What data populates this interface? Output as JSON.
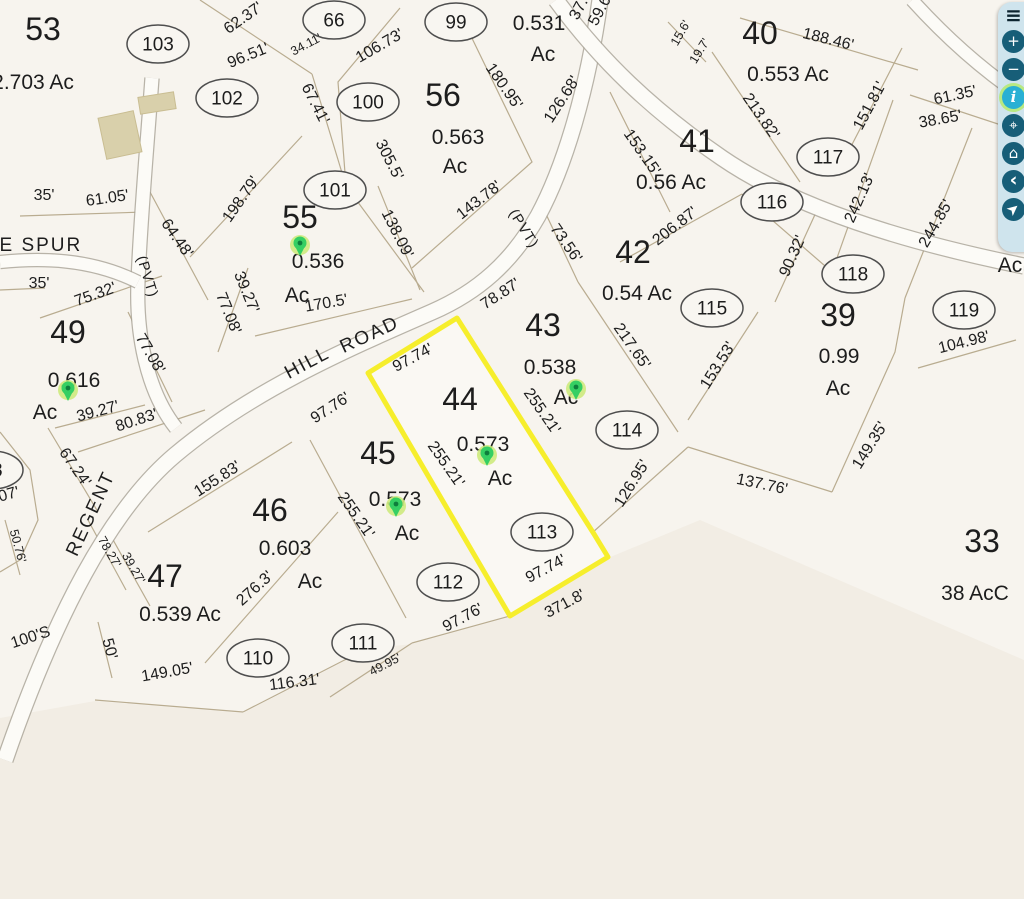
{
  "map": {
    "background": "#f7f4ee",
    "shade_color": "#efe8dc",
    "line_color": "#b9ac90",
    "road_fill": "#fcfbf7",
    "road_casing": "#a8a296",
    "highlight_color": "#f6ee2c",
    "pin_color": "#35cf63",
    "pin_dot_color": "#0e7e3c",
    "pin_glow_color": "#cdea7d",
    "building_color": "#d9d0ab",
    "labels": [
      {
        "t": "53",
        "x": 43,
        "y": 40,
        "r": 0,
        "c": "lot"
      },
      {
        "t": "55",
        "x": 300,
        "y": 228,
        "r": 0,
        "c": "lot"
      },
      {
        "t": "56",
        "x": 443,
        "y": 106,
        "r": 0,
        "c": "lot"
      },
      {
        "t": "40",
        "x": 760,
        "y": 44,
        "r": 0,
        "c": "lot"
      },
      {
        "t": "41",
        "x": 697,
        "y": 152,
        "r": 0,
        "c": "lot"
      },
      {
        "t": "42",
        "x": 633,
        "y": 263,
        "r": 0,
        "c": "lot"
      },
      {
        "t": "43",
        "x": 543,
        "y": 336,
        "r": 0,
        "c": "lot"
      },
      {
        "t": "39",
        "x": 838,
        "y": 326,
        "r": 0,
        "c": "lot"
      },
      {
        "t": "44",
        "x": 460,
        "y": 410,
        "r": 0,
        "c": "lot"
      },
      {
        "t": "45",
        "x": 378,
        "y": 464,
        "r": 0,
        "c": "lot"
      },
      {
        "t": "46",
        "x": 270,
        "y": 521,
        "r": 0,
        "c": "lot"
      },
      {
        "t": "47",
        "x": 165,
        "y": 587,
        "r": 0,
        "c": "lot"
      },
      {
        "t": "49",
        "x": 68,
        "y": 343,
        "r": 0,
        "c": "lot"
      },
      {
        "t": "33",
        "x": 982,
        "y": 552,
        "r": 0,
        "c": "lot"
      },
      {
        "t": "2.703 Ac",
        "x": 33,
        "y": 89,
        "r": 0,
        "c": "ac"
      },
      {
        "t": "0.536",
        "x": 318,
        "y": 268,
        "r": 0,
        "c": "ac"
      },
      {
        "t": "Ac",
        "x": 297,
        "y": 302,
        "r": 0,
        "c": "ac"
      },
      {
        "t": "0.563",
        "x": 458,
        "y": 144,
        "r": 0,
        "c": "ac"
      },
      {
        "t": "Ac",
        "x": 455,
        "y": 173,
        "r": 0,
        "c": "ac"
      },
      {
        "t": "0.531",
        "x": 539,
        "y": 30,
        "r": 0,
        "c": "ac"
      },
      {
        "t": "Ac",
        "x": 543,
        "y": 61,
        "r": 0,
        "c": "ac"
      },
      {
        "t": "0.553 Ac",
        "x": 788,
        "y": 81,
        "r": 0,
        "c": "ac"
      },
      {
        "t": "0.56 Ac",
        "x": 671,
        "y": 189,
        "r": 0,
        "c": "ac"
      },
      {
        "t": "0.54 Ac",
        "x": 637,
        "y": 300,
        "r": 0,
        "c": "ac"
      },
      {
        "t": "0.538",
        "x": 550,
        "y": 374,
        "r": 0,
        "c": "ac"
      },
      {
        "t": "Ac",
        "x": 566,
        "y": 404,
        "r": 0,
        "c": "ac"
      },
      {
        "t": "0.99",
        "x": 839,
        "y": 363,
        "r": 0,
        "c": "ac"
      },
      {
        "t": "Ac",
        "x": 838,
        "y": 395,
        "r": 0,
        "c": "ac"
      },
      {
        "t": "0.573",
        "x": 483,
        "y": 451,
        "r": 0,
        "c": "ac"
      },
      {
        "t": "Ac",
        "x": 500,
        "y": 485,
        "r": 0,
        "c": "ac"
      },
      {
        "t": "0.573",
        "x": 395,
        "y": 506,
        "r": 0,
        "c": "ac"
      },
      {
        "t": "Ac",
        "x": 407,
        "y": 540,
        "r": 0,
        "c": "ac"
      },
      {
        "t": "0.603",
        "x": 285,
        "y": 555,
        "r": 0,
        "c": "ac"
      },
      {
        "t": "Ac",
        "x": 310,
        "y": 588,
        "r": 0,
        "c": "ac"
      },
      {
        "t": "0.539 Ac",
        "x": 180,
        "y": 621,
        "r": 0,
        "c": "ac"
      },
      {
        "t": "0.616",
        "x": 74,
        "y": 387,
        "r": 0,
        "c": "ac"
      },
      {
        "t": "Ac",
        "x": 45,
        "y": 419,
        "r": 0,
        "c": "ac"
      },
      {
        "t": "38 AcC",
        "x": 975,
        "y": 600,
        "r": 0,
        "c": "ac"
      },
      {
        "t": "Ac",
        "x": 1010,
        "y": 272,
        "r": 0,
        "c": "ac"
      },
      {
        "t": "62.37'",
        "x": 246,
        "y": 22,
        "r": -35,
        "c": "dim"
      },
      {
        "t": "96.51'",
        "x": 250,
        "y": 60,
        "r": -22,
        "c": "dim"
      },
      {
        "t": "34.11'",
        "x": 308,
        "y": 48,
        "r": -28,
        "c": "dims"
      },
      {
        "t": "106.73'",
        "x": 382,
        "y": 50,
        "r": -30,
        "c": "dim"
      },
      {
        "t": "67.41'",
        "x": 311,
        "y": 106,
        "r": 63,
        "c": "dim"
      },
      {
        "t": "305.5'",
        "x": 385,
        "y": 162,
        "r": 63,
        "c": "dim"
      },
      {
        "t": "180.95'",
        "x": 500,
        "y": 89,
        "r": 55,
        "c": "dim"
      },
      {
        "t": "126.68'",
        "x": 566,
        "y": 102,
        "r": -57,
        "c": "dim"
      },
      {
        "t": "37.",
        "x": 583,
        "y": 11,
        "r": -62,
        "c": "dim"
      },
      {
        "t": "59.6",
        "x": 604,
        "y": 13,
        "r": -62,
        "c": "dim"
      },
      {
        "t": "15.6'",
        "x": 684,
        "y": 35,
        "r": -60,
        "c": "dims"
      },
      {
        "t": "19.7'",
        "x": 703,
        "y": 53,
        "r": -58,
        "c": "dims"
      },
      {
        "t": "188.46'",
        "x": 827,
        "y": 44,
        "r": 14,
        "c": "dim"
      },
      {
        "t": "151.81'",
        "x": 874,
        "y": 108,
        "r": -62,
        "c": "dim"
      },
      {
        "t": "61.35'",
        "x": 956,
        "y": 100,
        "r": -12,
        "c": "dim"
      },
      {
        "t": "38.65'",
        "x": 941,
        "y": 124,
        "r": -10,
        "c": "dim"
      },
      {
        "t": "213.82'",
        "x": 757,
        "y": 119,
        "r": 55,
        "c": "dim"
      },
      {
        "t": "153.15'",
        "x": 638,
        "y": 155,
        "r": 55,
        "c": "dim"
      },
      {
        "t": "242.13'",
        "x": 864,
        "y": 200,
        "r": -66,
        "c": "dim"
      },
      {
        "t": "244.85'",
        "x": 940,
        "y": 226,
        "r": -60,
        "c": "dim"
      },
      {
        "t": "206.87'",
        "x": 678,
        "y": 230,
        "r": -38,
        "c": "dim"
      },
      {
        "t": "90.32'",
        "x": 797,
        "y": 258,
        "r": -66,
        "c": "dim"
      },
      {
        "t": "153.53'",
        "x": 722,
        "y": 368,
        "r": -58,
        "c": "dim"
      },
      {
        "t": "104.98'",
        "x": 965,
        "y": 347,
        "r": -14,
        "c": "dim"
      },
      {
        "t": "149.35'",
        "x": 874,
        "y": 448,
        "r": -58,
        "c": "dim"
      },
      {
        "t": "137.76'",
        "x": 761,
        "y": 489,
        "r": 12,
        "c": "dim"
      },
      {
        "t": "126.95'",
        "x": 636,
        "y": 486,
        "r": -58,
        "c": "dim"
      },
      {
        "t": "217.65'",
        "x": 628,
        "y": 349,
        "r": 55,
        "c": "dim"
      },
      {
        "t": "73.56'",
        "x": 562,
        "y": 246,
        "r": 55,
        "c": "dim"
      },
      {
        "t": "78.87'",
        "x": 503,
        "y": 298,
        "r": -33,
        "c": "dim"
      },
      {
        "t": "198.79'",
        "x": 245,
        "y": 202,
        "r": -55,
        "c": "dim"
      },
      {
        "t": "138.09'",
        "x": 393,
        "y": 236,
        "r": 63,
        "c": "dim"
      },
      {
        "t": "143.78'",
        "x": 482,
        "y": 204,
        "r": -38,
        "c": "dim"
      },
      {
        "t": "170.5'",
        "x": 327,
        "y": 308,
        "r": -10,
        "c": "dim"
      },
      {
        "t": "39.27'",
        "x": 242,
        "y": 294,
        "r": 68,
        "c": "dim"
      },
      {
        "t": "77.08'",
        "x": 224,
        "y": 315,
        "r": 68,
        "c": "dim"
      },
      {
        "t": "35'",
        "x": 44,
        "y": 200,
        "r": 0,
        "c": "dim"
      },
      {
        "t": "61.05'",
        "x": 108,
        "y": 203,
        "r": -8,
        "c": "dim"
      },
      {
        "t": "64.48'",
        "x": 173,
        "y": 241,
        "r": 55,
        "c": "dim"
      },
      {
        "t": "35'",
        "x": 39,
        "y": 288,
        "r": 0,
        "c": "dim"
      },
      {
        "t": "75.32'",
        "x": 97,
        "y": 299,
        "r": -20,
        "c": "dim"
      },
      {
        "t": "77.08'",
        "x": 146,
        "y": 356,
        "r": 60,
        "c": "dim"
      },
      {
        "t": "39.27'",
        "x": 99,
        "y": 416,
        "r": -15,
        "c": "dim"
      },
      {
        "t": "80.83'",
        "x": 138,
        "y": 425,
        "r": -18,
        "c": "dim"
      },
      {
        "t": "67.24'",
        "x": 71,
        "y": 470,
        "r": 55,
        "c": "dim"
      },
      {
        "t": "50.76'",
        "x": 14,
        "y": 547,
        "r": 75,
        "c": "dims"
      },
      {
        "t": "07'",
        "x": 10,
        "y": 499,
        "r": -15,
        "c": "dim"
      },
      {
        "t": "155.83'",
        "x": 220,
        "y": 483,
        "r": -33,
        "c": "dim"
      },
      {
        "t": "78.27'",
        "x": 106,
        "y": 554,
        "r": 60,
        "c": "dims"
      },
      {
        "t": "39.27'",
        "x": 130,
        "y": 570,
        "r": 60,
        "c": "dims"
      },
      {
        "t": "100'S",
        "x": 32,
        "y": 642,
        "r": -18,
        "c": "dim"
      },
      {
        "t": "50'",
        "x": 105,
        "y": 650,
        "r": 75,
        "c": "dim"
      },
      {
        "t": "149.05'",
        "x": 168,
        "y": 677,
        "r": -10,
        "c": "dim"
      },
      {
        "t": "116.31'",
        "x": 295,
        "y": 687,
        "r": -7,
        "c": "dim"
      },
      {
        "t": "276.3'",
        "x": 258,
        "y": 592,
        "r": -42,
        "c": "dim"
      },
      {
        "t": "255.21'",
        "x": 352,
        "y": 518,
        "r": 55,
        "c": "dim"
      },
      {
        "t": "255.21'",
        "x": 442,
        "y": 467,
        "r": 55,
        "c": "dim"
      },
      {
        "t": "255.21'",
        "x": 538,
        "y": 414,
        "r": 55,
        "c": "dim"
      },
      {
        "t": "97.76'",
        "x": 333,
        "y": 412,
        "r": -33,
        "c": "dim"
      },
      {
        "t": "97.74'",
        "x": 415,
        "y": 362,
        "r": -28,
        "c": "dim"
      },
      {
        "t": "97.74'",
        "x": 548,
        "y": 573,
        "r": -28,
        "c": "dim"
      },
      {
        "t": "371.8'",
        "x": 567,
        "y": 608,
        "r": -28,
        "c": "dim"
      },
      {
        "t": "97.76'",
        "x": 465,
        "y": 622,
        "r": -28,
        "c": "dim"
      },
      {
        "t": "49.95'",
        "x": 387,
        "y": 668,
        "r": -28,
        "c": "dims"
      },
      {
        "t": "HE SPUR",
        "x": 33,
        "y": 251,
        "r": 0,
        "c": "road"
      },
      {
        "t": "(PVT)",
        "x": 143,
        "y": 278,
        "r": 73,
        "c": "roads"
      },
      {
        "t": "REGENT",
        "x": 96,
        "y": 516,
        "r": -65,
        "c": "road"
      },
      {
        "t": "HILL",
        "x": 310,
        "y": 368,
        "r": -28,
        "c": "road"
      },
      {
        "t": "ROAD",
        "x": 372,
        "y": 340,
        "r": -25,
        "c": "road"
      },
      {
        "t": "(PVT)",
        "x": 520,
        "y": 231,
        "r": 58,
        "c": "roads"
      }
    ],
    "point_ellipses": [
      {
        "n": "103",
        "x": 158,
        "y": 44
      },
      {
        "n": "102",
        "x": 227,
        "y": 98
      },
      {
        "n": "66",
        "x": 334,
        "y": 20
      },
      {
        "n": "99",
        "x": 456,
        "y": 22
      },
      {
        "n": "100",
        "x": 368,
        "y": 102
      },
      {
        "n": "101",
        "x": 335,
        "y": 190
      },
      {
        "n": "117",
        "x": 828,
        "y": 157
      },
      {
        "n": "116",
        "x": 772,
        "y": 202
      },
      {
        "n": "118",
        "x": 853,
        "y": 274
      },
      {
        "n": "115",
        "x": 712,
        "y": 308
      },
      {
        "n": "119",
        "x": 964,
        "y": 310
      },
      {
        "n": "114",
        "x": 627,
        "y": 430
      },
      {
        "n": "113",
        "x": 542,
        "y": 532
      },
      {
        "n": "112",
        "x": 448,
        "y": 582
      },
      {
        "n": "111",
        "x": 363,
        "y": 643
      },
      {
        "n": "110",
        "x": 258,
        "y": 658
      },
      {
        "n": "08",
        "x": -8,
        "y": 470
      }
    ],
    "pins": [
      {
        "x": 300,
        "y": 251
      },
      {
        "x": 68,
        "y": 396
      },
      {
        "x": 396,
        "y": 512
      },
      {
        "x": 487,
        "y": 461
      },
      {
        "x": 576,
        "y": 395
      }
    ],
    "buildings": [
      {
        "cx": 120,
        "cy": 135,
        "w": 36,
        "h": 42,
        "r": -12
      },
      {
        "cx": 157,
        "cy": 103,
        "w": 36,
        "h": 17,
        "r": -9
      }
    ],
    "highlight_parcel": [
      368,
      373,
      457,
      318,
      594,
      534,
      608,
      557,
      510,
      616
    ],
    "shade_polygon": [
      0,
      718,
      95,
      701,
      243,
      713,
      368,
      649,
      412,
      644,
      510,
      617,
      608,
      558,
      700,
      520,
      1024,
      660,
      1024,
      899,
      0,
      899
    ],
    "boundaries": [
      [
        200,
        0,
        312,
        74
      ],
      [
        312,
        74,
        346,
        186
      ],
      [
        346,
        186,
        424,
        292
      ],
      [
        400,
        8,
        338,
        82,
        346,
        186
      ],
      [
        468,
        30,
        532,
        162,
        412,
        268
      ],
      [
        378,
        186,
        420,
        290
      ],
      [
        190,
        257,
        302,
        136
      ],
      [
        255,
        336,
        412,
        299
      ],
      [
        248,
        268,
        218,
        352
      ],
      [
        20,
        216,
        145,
        212
      ],
      [
        150,
        192,
        208,
        300
      ],
      [
        40,
        318,
        162,
        276
      ],
      [
        0,
        290,
        45,
        288
      ],
      [
        128,
        312,
        172,
        402
      ],
      [
        55,
        428,
        145,
        405
      ],
      [
        78,
        452,
        205,
        410
      ],
      [
        48,
        428,
        98,
        512
      ],
      [
        5,
        520,
        20,
        575
      ],
      [
        148,
        532,
        292,
        442
      ],
      [
        310,
        440,
        406,
        618
      ],
      [
        205,
        663,
        338,
        512
      ],
      [
        88,
        520,
        126,
        590
      ],
      [
        112,
        538,
        150,
        606
      ],
      [
        98,
        622,
        112,
        678
      ],
      [
        95,
        700,
        243,
        712
      ],
      [
        243,
        712,
        368,
        648
      ],
      [
        330,
        697,
        412,
        643
      ],
      [
        412,
        643,
        510,
        616
      ],
      [
        592,
        533,
        688,
        447
      ],
      [
        688,
        447,
        832,
        492
      ],
      [
        832,
        492,
        895,
        352,
        905,
        298
      ],
      [
        545,
        212,
        578,
        282
      ],
      [
        578,
        282,
        678,
        432
      ],
      [
        620,
        262,
        742,
        194
      ],
      [
        775,
        302,
        818,
        208
      ],
      [
        688,
        420,
        758,
        312
      ],
      [
        742,
        194,
        832,
        272
      ],
      [
        832,
        272,
        893,
        100
      ],
      [
        905,
        298,
        972,
        128
      ],
      [
        712,
        52,
        800,
        182
      ],
      [
        610,
        92,
        670,
        212
      ],
      [
        845,
        158,
        902,
        48
      ],
      [
        668,
        22,
        706,
        62
      ],
      [
        740,
        18,
        918,
        70
      ],
      [
        918,
        368,
        1016,
        340
      ],
      [
        910,
        95,
        1010,
        128
      ],
      [
        0,
        432,
        30,
        470,
        38,
        520,
        20,
        560,
        0,
        572
      ]
    ],
    "road_paths": [
      {
        "d": "M 5,760 C 55,615 110,510 175,455 C 250,392 340,352 432,312 C 478,292 512,262 538,216 C 565,166 588,88 600,0",
        "w": 15
      },
      {
        "d": "M 152,78 C 146,160 140,225 138,282 C 136,332 146,390 176,428",
        "w": 13
      },
      {
        "d": "M 0,262 C 40,258 90,258 138,282",
        "w": 12
      },
      {
        "d": "M 556,0 C 600,60 652,110 722,158 C 795,208 905,242 1024,266",
        "w": 15
      },
      {
        "d": "M 912,0 C 950,42 988,74 1024,98",
        "w": 12
      }
    ]
  },
  "toolbar": {
    "background": "#cfe4ed",
    "button_color": "#175e78",
    "active_button_color": "#29b0d4",
    "active_ring_color": "#b8e982",
    "items": [
      {
        "name": "menu",
        "glyph": "≡",
        "menu": true,
        "active": false
      },
      {
        "name": "zoom-in",
        "glyph": "+",
        "active": false
      },
      {
        "name": "zoom-out",
        "glyph": "−",
        "active": false
      },
      {
        "name": "info",
        "glyph": "i",
        "active": true
      },
      {
        "name": "locate",
        "glyph": "⌖",
        "active": false
      },
      {
        "name": "home",
        "glyph": "⌂",
        "active": false
      },
      {
        "name": "back",
        "glyph": "‹",
        "active": false
      },
      {
        "name": "navigate",
        "glyph": "➤",
        "active": false,
        "rotate": -40
      }
    ]
  }
}
